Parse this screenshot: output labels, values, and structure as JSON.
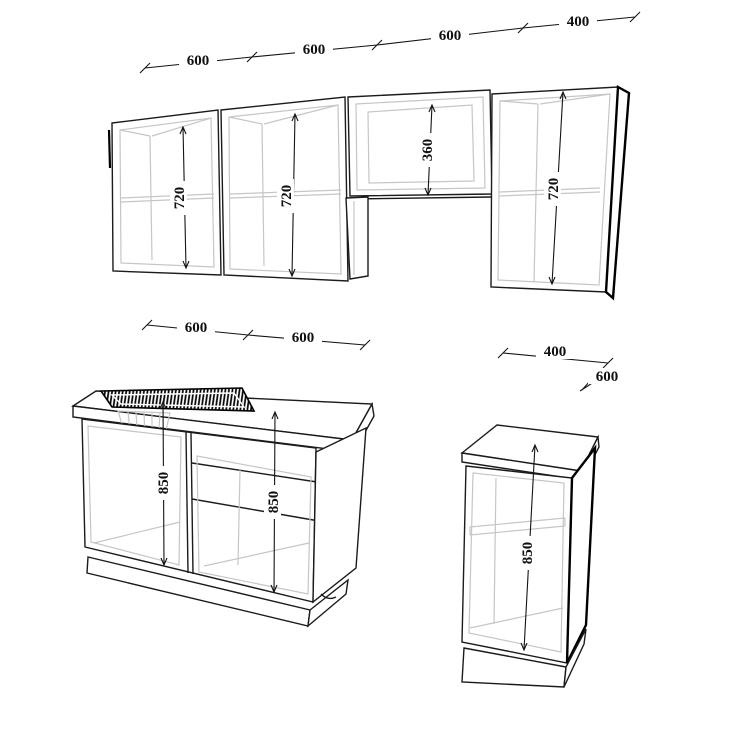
{
  "drawing": {
    "type": "kitchen-cabinet-perspective-drawing",
    "units": "mm",
    "dims": {
      "top": [
        "600",
        "600",
        "600",
        "400"
      ],
      "wall": [
        "720",
        "720",
        "360",
        "720"
      ],
      "base_left_top": [
        "600",
        "600"
      ],
      "base_left_heights": [
        "850",
        "850"
      ],
      "base_right": {
        "width": "400",
        "depth": "600",
        "height": "850"
      }
    },
    "colors": {
      "line": "#1b1b1b",
      "interior_line": "#c6c6c6",
      "background": "#ffffff"
    }
  }
}
